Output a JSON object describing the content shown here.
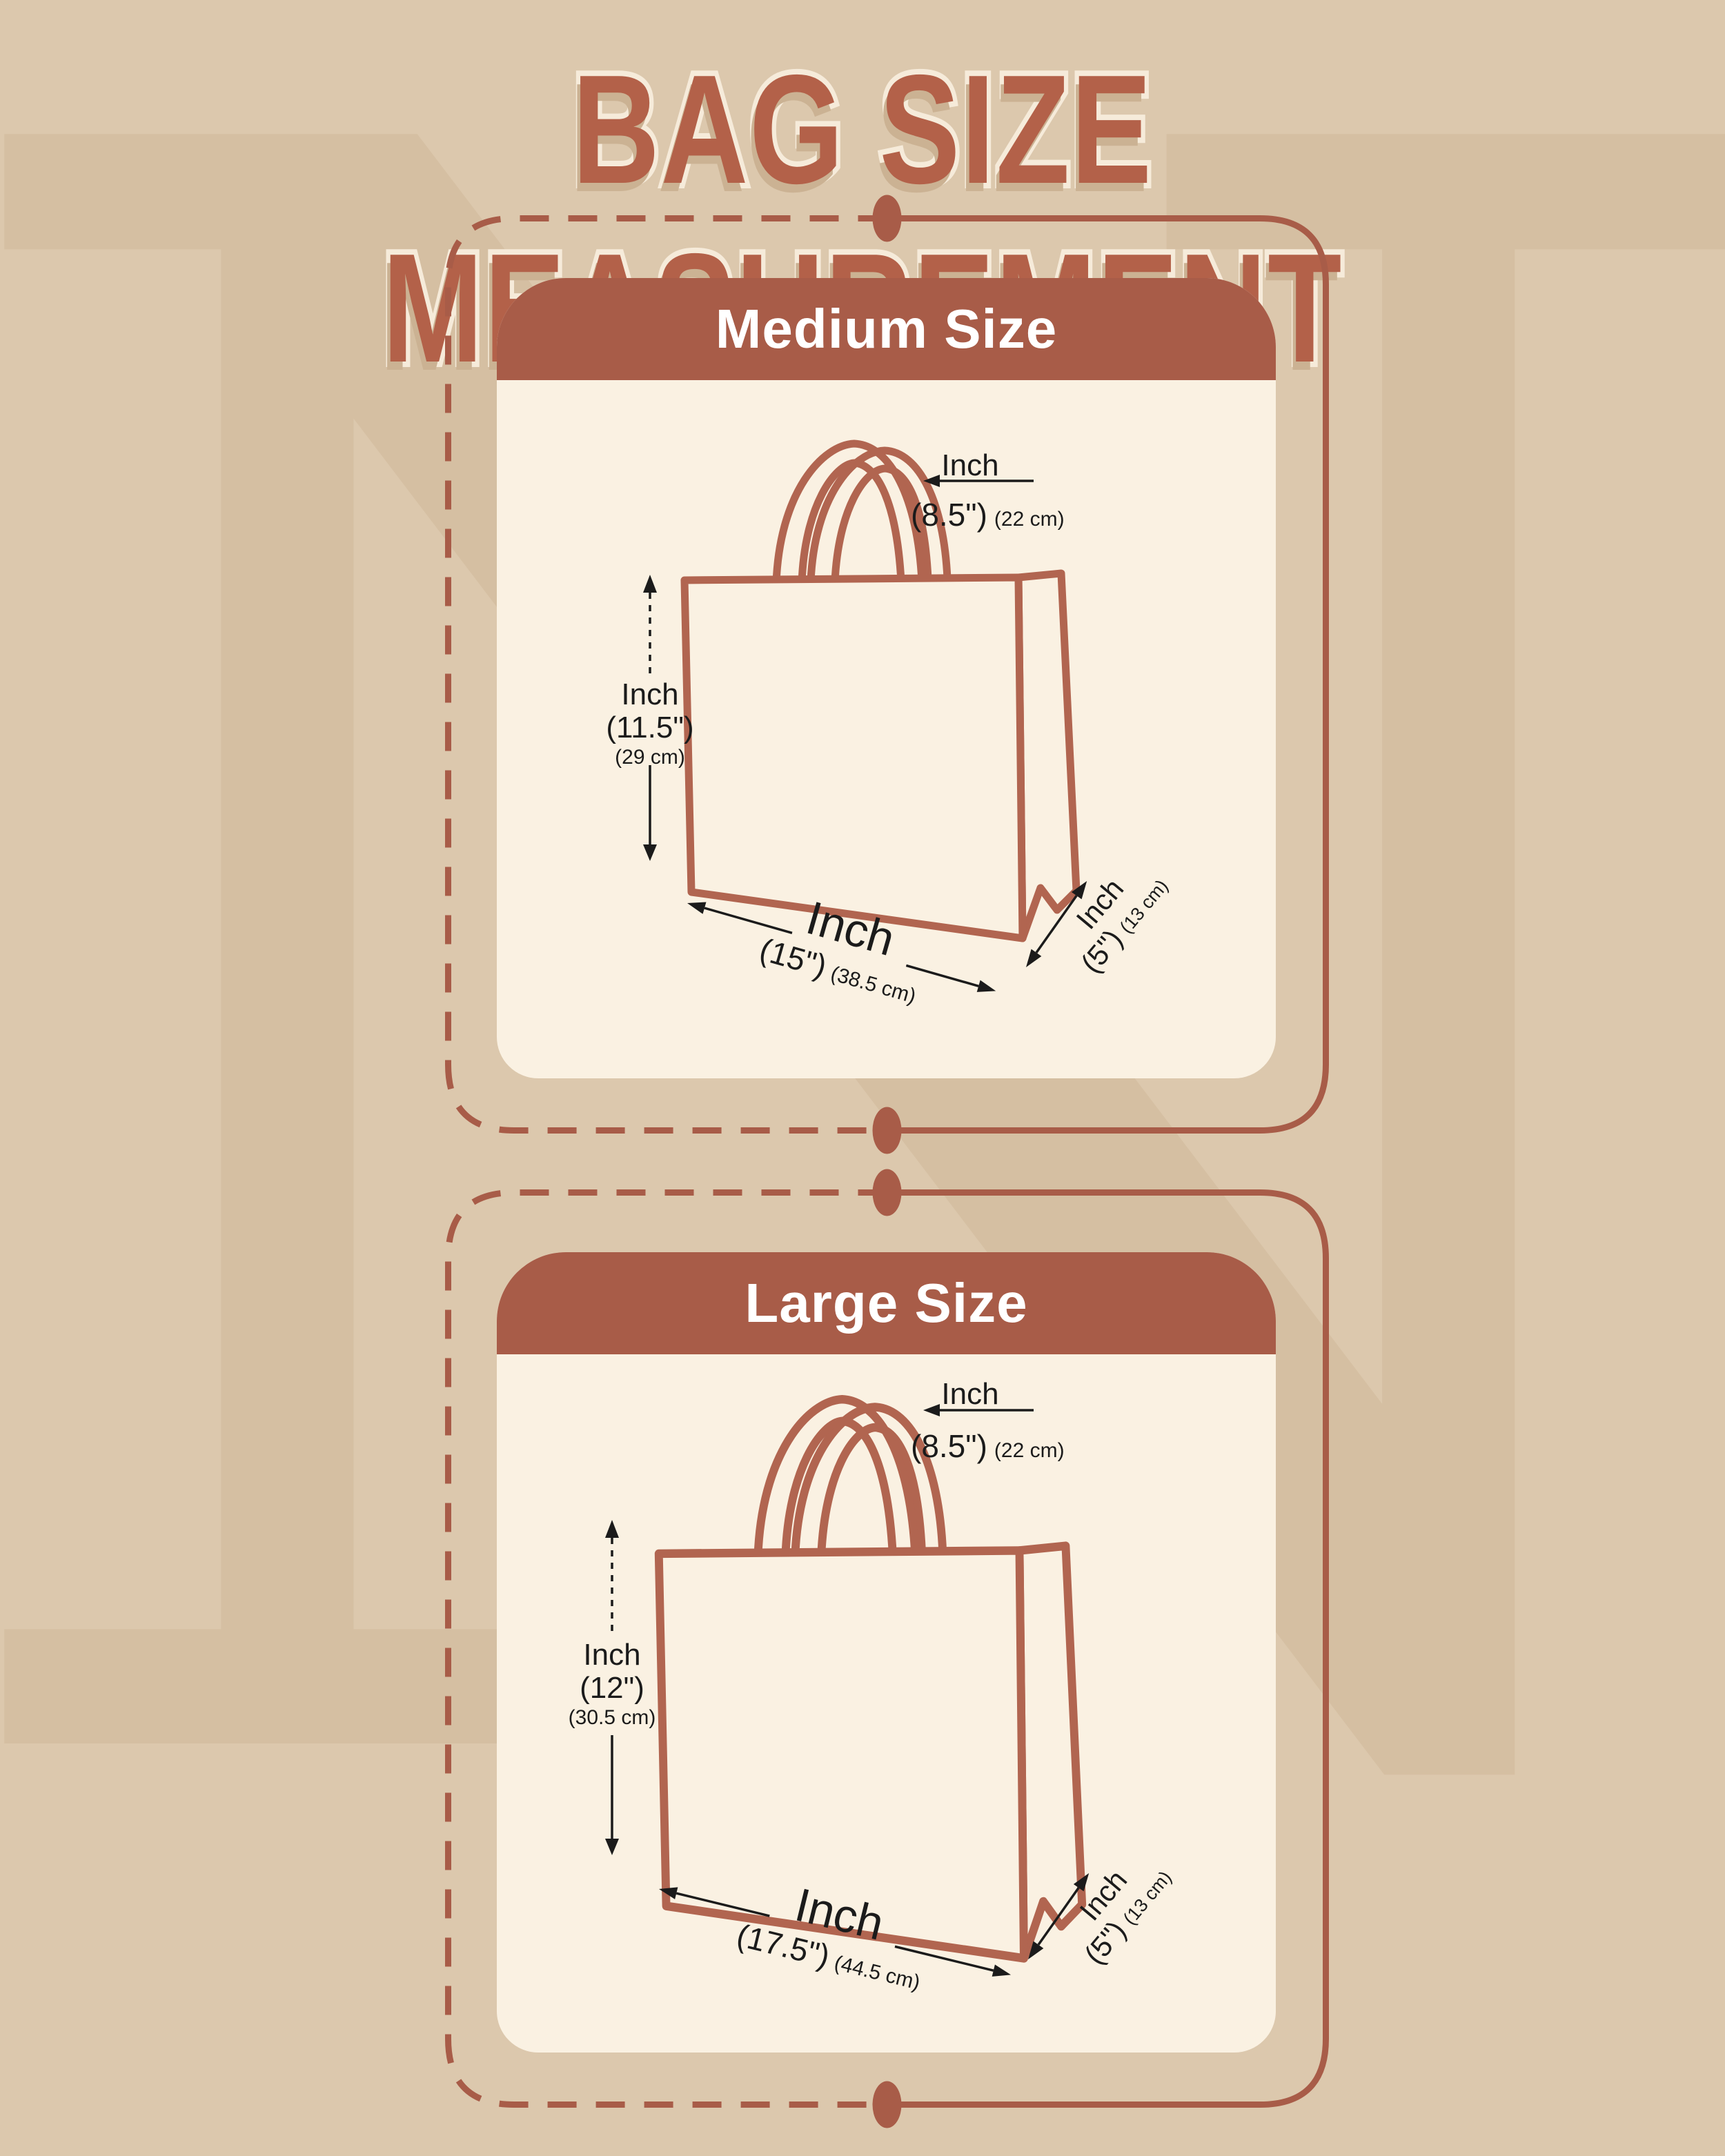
{
  "title": "BAG SIZE MEASUREMENT",
  "watermark": "N",
  "colors": {
    "bg": "#dcc8ad",
    "wm": "#d5bfa2",
    "accent": "#a85c48",
    "bag": "#b16550",
    "cream": "#faf1e2",
    "title": "#b36149",
    "titlestroke": "#f6ebda",
    "ink": "#1b1b1b"
  },
  "panels": [
    {
      "header": "Medium Size",
      "handle": {
        "label": "Inch",
        "inches": "(8.5\")",
        "cm": "(22 cm)"
      },
      "height": {
        "label": "Inch",
        "inches": "(11.5\")",
        "cm": "(29 cm)"
      },
      "width": {
        "label": "Inch",
        "inches": "(15\")",
        "cm": "(38.5 cm)"
      },
      "depth": {
        "label": "Inch",
        "inches": "(5\")",
        "cm": "(13 cm)"
      }
    },
    {
      "header": "Large Size",
      "handle": {
        "label": "Inch",
        "inches": "(8.5\")",
        "cm": "(22 cm)"
      },
      "height": {
        "label": "Inch",
        "inches": "(12\")",
        "cm": "(30.5 cm)"
      },
      "width": {
        "label": "Inch",
        "inches": "(17.5\")",
        "cm": "(44.5 cm)"
      },
      "depth": {
        "label": "Inch",
        "inches": "(5\")",
        "cm": "(13 cm)"
      }
    }
  ]
}
